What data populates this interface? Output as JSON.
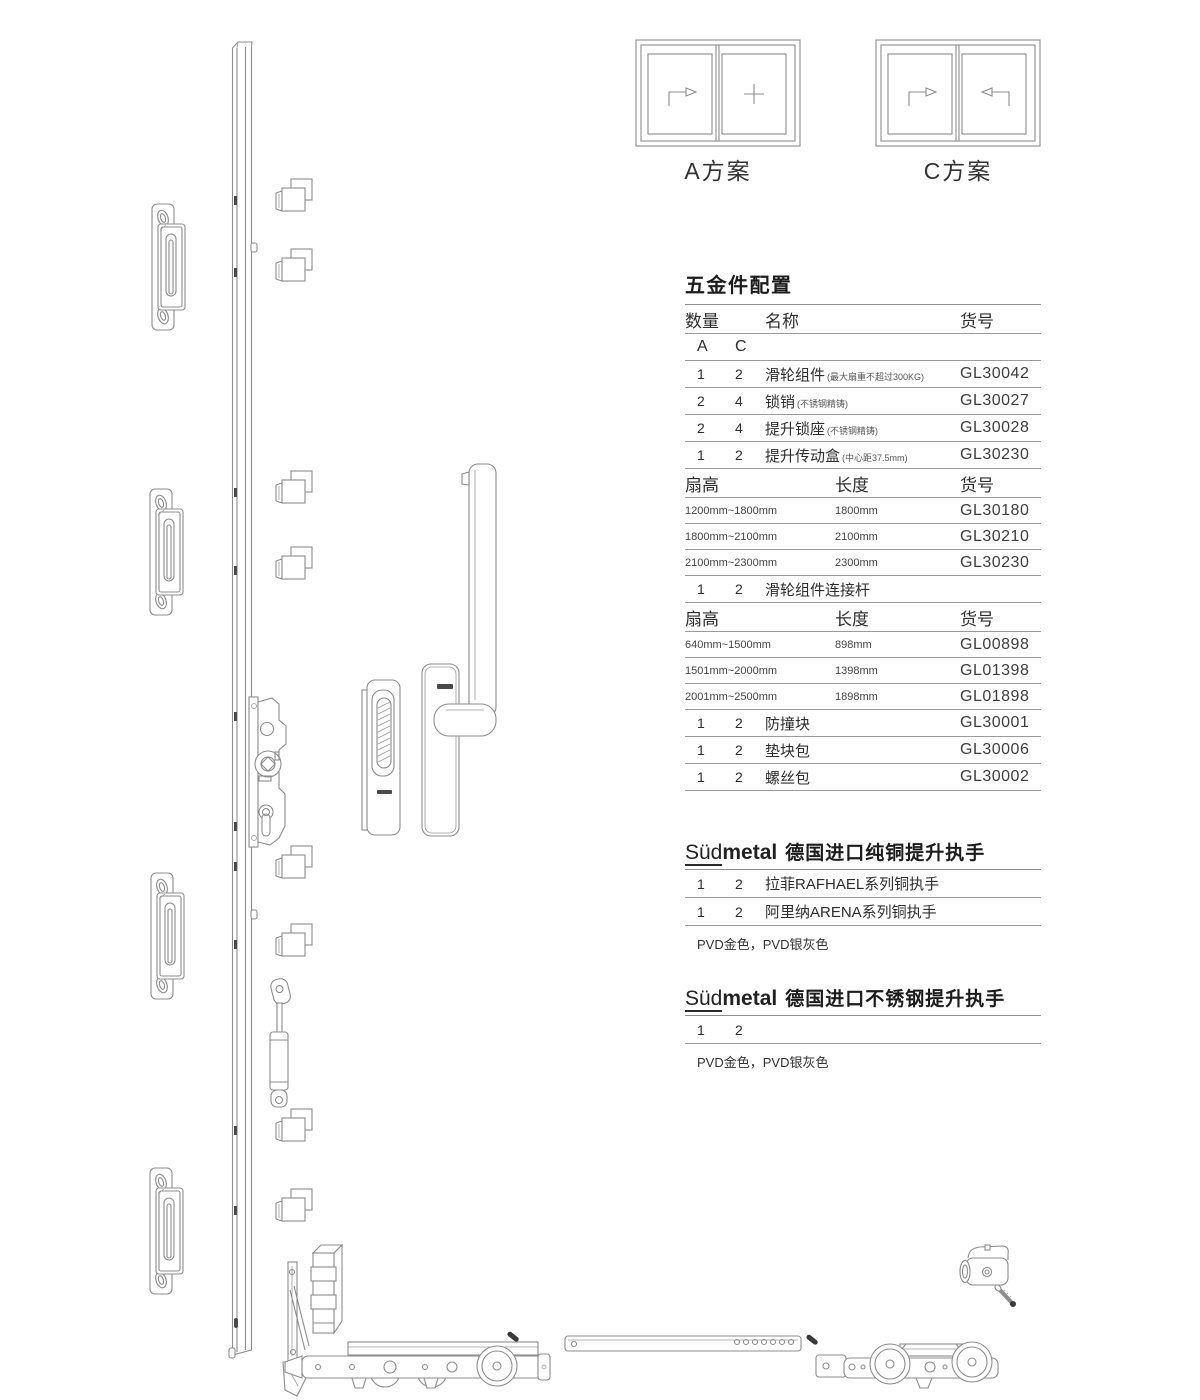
{
  "schemes": [
    {
      "label": "A方案"
    },
    {
      "label": "C方案"
    }
  ],
  "hardware_table": {
    "title": "五金件配置",
    "columns": {
      "qty": "数量",
      "name": "名称",
      "code": "货号"
    },
    "variant_a": "A",
    "variant_c": "C",
    "items": [
      {
        "a": "1",
        "c": "2",
        "name": "滑轮组件",
        "note": "(最大扇重不超过300KG)",
        "code": "GL30042"
      },
      {
        "a": "2",
        "c": "4",
        "name": "锁销",
        "note": "(不锈钢精铸)",
        "code": "GL30027"
      },
      {
        "a": "2",
        "c": "4",
        "name": "提升锁座",
        "note": "(不锈钢精铸)",
        "code": "GL30028"
      },
      {
        "a": "1",
        "c": "2",
        "name": "提升传动盒",
        "note": "(中心距37.5mm)",
        "code": "GL30230"
      }
    ],
    "size_header_1": {
      "fan": "扇高",
      "len": "长度",
      "code": "货号"
    },
    "sizes_1": [
      {
        "range": "1200mm~1800mm",
        "len": "1800mm",
        "code": "GL30180"
      },
      {
        "range": "1800mm~2100mm",
        "len": "2100mm",
        "code": "GL30210"
      },
      {
        "range": "2100mm~2300mm",
        "len": "2300mm",
        "code": "GL30230"
      }
    ],
    "connector_row": {
      "a": "1",
      "c": "2",
      "name": "滑轮组件连接杆"
    },
    "size_header_2": {
      "fan": "扇高",
      "len": "长度",
      "code": "货号"
    },
    "sizes_2": [
      {
        "range": "640mm~1500mm",
        "len": "898mm",
        "code": "GL00898"
      },
      {
        "range": "1501mm~2000mm",
        "len": "1398mm",
        "code": "GL01398"
      },
      {
        "range": "2001mm~2500mm",
        "len": "1898mm",
        "code": "GL01898"
      }
    ],
    "tail_items": [
      {
        "a": "1",
        "c": "2",
        "name": "防撞块",
        "code": "GL30001"
      },
      {
        "a": "1",
        "c": "2",
        "name": "垫块包",
        "code": "GL30006"
      },
      {
        "a": "1",
        "c": "2",
        "name": "螺丝包",
        "code": "GL30002"
      }
    ]
  },
  "brand_sections": [
    {
      "logo_light": "Süd",
      "logo_bold": "metal",
      "title": "德国进口纯铜提升执手",
      "rows": [
        {
          "a": "1",
          "c": "2",
          "name": "拉菲RAFHAEL系列铜执手"
        },
        {
          "a": "1",
          "c": "2",
          "name": "阿里纳ARENA系列铜执手"
        }
      ],
      "note": "PVD金色，PVD银灰色"
    },
    {
      "logo_light": "Süd",
      "logo_bold": "metal",
      "title": "德国进口不锈钢提升执手",
      "rows": [
        {
          "a": "1",
          "c": "2",
          "name": ""
        }
      ],
      "note": "PVD金色，PVD银灰色"
    }
  ],
  "colors": {
    "drawing_line": "#8c8c8c",
    "table_rule": "#9b9b9b",
    "text": "#2e2e2e",
    "dark_detail": "#3a3a3a"
  }
}
